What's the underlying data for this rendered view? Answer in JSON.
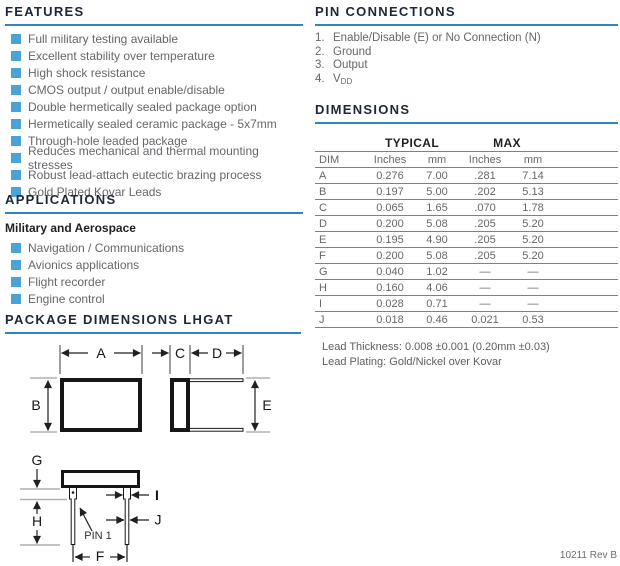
{
  "page": {
    "footer": "10211 Rev B"
  },
  "colors": {
    "accent_blue": "#2e86c1",
    "bullet_blue": "#4ba2d6",
    "table_rule_blue": "#4292c6",
    "body_text_gray": "#66676b",
    "heading_navy": "#1d2736"
  },
  "features": {
    "title": "FEATURES",
    "items": [
      "Full military testing available",
      "Excellent stability over temperature",
      "High shock resistance",
      "CMOS output / output enable/disable",
      "Double hermetically sealed package option",
      "Hermetically sealed ceramic package - 5x7mm",
      "Through-hole leaded package",
      "Reduces mechanical and thermal mounting stresses",
      "Robust lead-attach eutectic brazing process",
      "Gold Plated Kovar Leads"
    ]
  },
  "applications": {
    "title": "APPLICATIONS",
    "subtitle": "Military and Aerospace",
    "items": [
      "Navigation / Communications",
      "Avionics applications",
      "Flight recorder",
      "Engine control"
    ]
  },
  "pin_connections": {
    "title": "PIN CONNECTIONS",
    "pins": [
      {
        "num": "1.",
        "label": "Enable/Disable (E) or No Connection (N)"
      },
      {
        "num": "2.",
        "label": "Ground"
      },
      {
        "num": "3.",
        "label": "Output"
      },
      {
        "num": "4.",
        "label": "V",
        "sub": "DD"
      }
    ]
  },
  "dimensions": {
    "title": "DIMENSIONS",
    "group_headers": [
      "TYPICAL",
      "MAX"
    ],
    "col_headers": [
      "DIM",
      "Inches",
      "mm",
      "Inches",
      "mm"
    ],
    "rows": [
      {
        "dim": "A",
        "typ_in": "0.276",
        "typ_mm": "7.00",
        "max_in": ".281",
        "max_mm": "7.14"
      },
      {
        "dim": "B",
        "typ_in": "0.197",
        "typ_mm": "5.00",
        "max_in": ".202",
        "max_mm": "5.13"
      },
      {
        "dim": "C",
        "typ_in": "0.065",
        "typ_mm": "1.65",
        "max_in": ".070",
        "max_mm": "1.78"
      },
      {
        "dim": "D",
        "typ_in": "0.200",
        "typ_mm": "5.08",
        "max_in": ".205",
        "max_mm": "5.20"
      },
      {
        "dim": "E",
        "typ_in": "0.195",
        "typ_mm": "4.90",
        "max_in": ".205",
        "max_mm": "5.20"
      },
      {
        "dim": "F",
        "typ_in": "0.200",
        "typ_mm": "5.08",
        "max_in": ".205",
        "max_mm": "5.20"
      },
      {
        "dim": "G",
        "typ_in": "0.040",
        "typ_mm": "1.02",
        "max_in": "—",
        "max_mm": "—"
      },
      {
        "dim": "H",
        "typ_in": "0.160",
        "typ_mm": "4.06",
        "max_in": "—",
        "max_mm": "—"
      },
      {
        "dim": "I",
        "typ_in": "0.028",
        "typ_mm": "0.71",
        "max_in": "—",
        "max_mm": "—"
      },
      {
        "dim": "J",
        "typ_in": "0.018",
        "typ_mm": "0.46",
        "max_in": "0.021",
        "max_mm": "0.53"
      }
    ],
    "notes": [
      "Lead Thickness: 0.008 ±0.001 (0.20mm ±0.03)",
      "Lead Plating: Gold/Nickel over Kovar"
    ]
  },
  "package_dimensions": {
    "title": "PACKAGE DIMENSIONS LHGAT",
    "labels": {
      "a": "A",
      "b": "B",
      "c": "C",
      "d": "D",
      "e": "E",
      "f": "F",
      "g": "G",
      "h": "H",
      "i": "I",
      "j": "J",
      "pin1": "PIN 1"
    }
  }
}
